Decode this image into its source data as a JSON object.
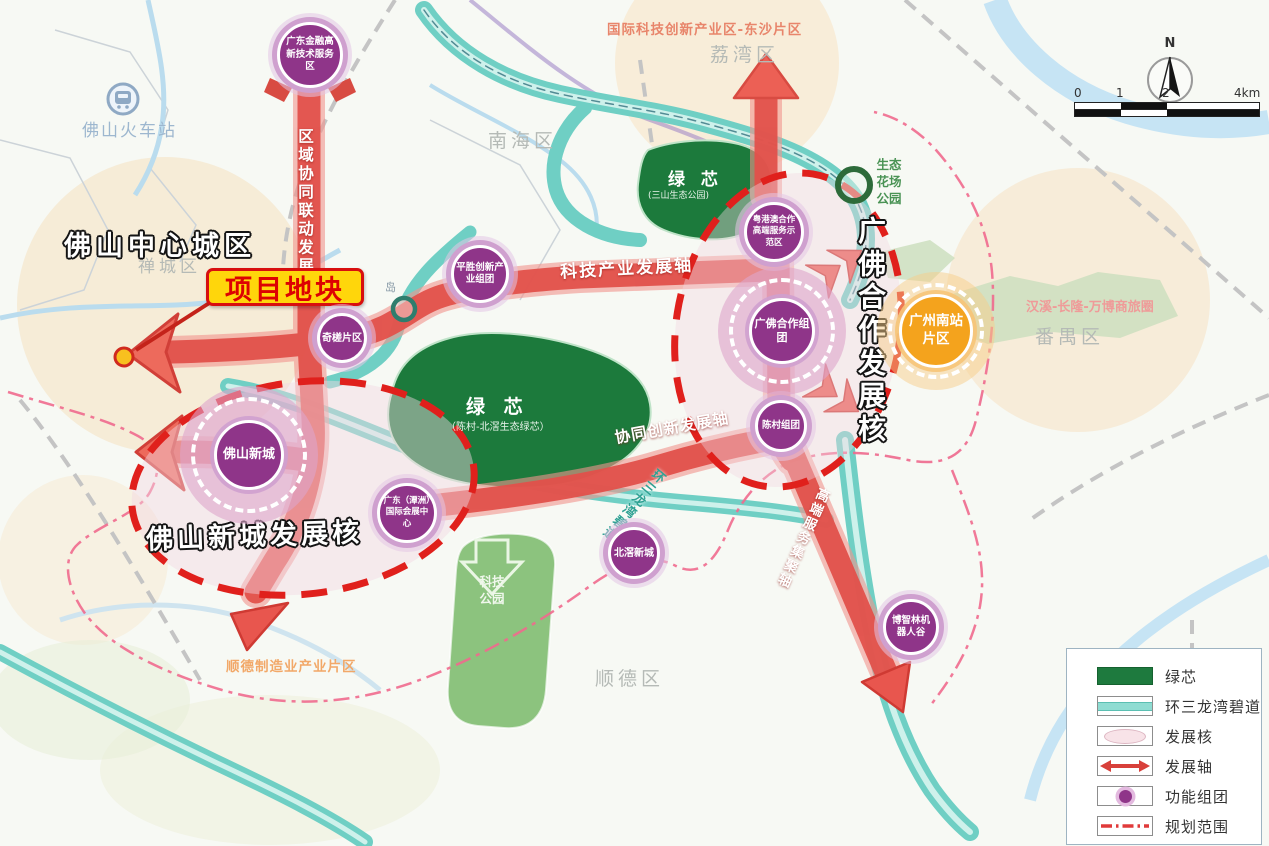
{
  "annotations": {
    "foshan_center_city": "佛山中心城区",
    "project_site": "项目地块",
    "station": "佛山火车站",
    "island": "岛"
  },
  "districts": {
    "nanhai": "南海区",
    "liwan": "荔湾区",
    "chancheng": "禅城区",
    "panyu": "番禺区",
    "shunde": "顺德区"
  },
  "areas": {
    "intl_innovation_zone": "国际科技创新产业区-东沙片区",
    "eco_flower_park": "生态花场公园",
    "hanxi_changlong_wanbo": "汉溪-长隆-万博商旅圈",
    "shunde_manufacturing": "顺德制造业产业片区",
    "tech_park": "科技公园",
    "green_core_sanshan": "绿 芯",
    "green_core_sanshan_sub": "(三山生态公园)",
    "green_core_chencun": "绿 芯",
    "green_core_chencun_sub": "（陈村-北滘生态绿芯）"
  },
  "axes": {
    "regional_axis": "区域协同联动发展轴",
    "tech_axis": "科技产业发展轴",
    "innovation_axis": "协同创新发展轴",
    "service_axis": "高端服务集聚轴",
    "greenway": "环三龙湾碧道"
  },
  "cores": {
    "guangfo_core": "广佛合作发展核",
    "newtown_core": "佛山新城发展核"
  },
  "nodes": {
    "gd_finance_hitech": "广东金融高新技术服务区",
    "pingsheng": "平胜创新产业组团",
    "qicha": "奇槎片区",
    "gba_highend_service": "粤港澳合作高端服务示范区",
    "guangfo_cluster": "广佛合作组团",
    "chencun_cluster": "陈村组团",
    "foshan_newtown": "佛山新城",
    "tanzhou_expo": "广东（潭洲）国际会展中心",
    "beijiao_newtown": "北滘新城",
    "bozhilin_robot_valley": "博智林机器人谷",
    "gz_south_station": "广州南站片区"
  },
  "legend": {
    "items": [
      {
        "label": "绿芯"
      },
      {
        "label": "环三龙湾碧道"
      },
      {
        "label": "发展核"
      },
      {
        "label": "发展轴"
      },
      {
        "label": "功能组团"
      },
      {
        "label": "规划范围"
      }
    ]
  },
  "compass": {
    "north": "N"
  },
  "scalebar": {
    "t0": "0",
    "t1": "1",
    "t2": "2",
    "t3": "4km"
  },
  "colors": {
    "axis_red": "#e2514b",
    "node_purple": "#8f3589",
    "green_core": "#1e7a3e",
    "greenway_teal": "#6fcfc4",
    "orange_node": "#f4a31d",
    "boundary_dash_red": "#e0201c",
    "planning_boundary_pink": "#ef6a8e",
    "project_site_yellow": "#ffd60b"
  }
}
